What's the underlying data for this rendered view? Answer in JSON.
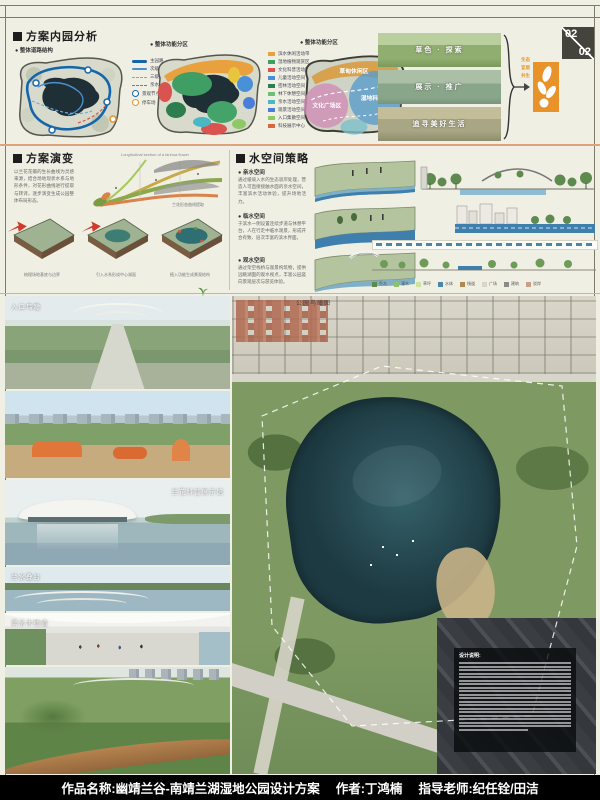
{
  "colors": {
    "paper": "#f0efe4",
    "accent_orange": "#e8922a",
    "footer_bg": "#000000",
    "divider_salmon": "#dfa27c",
    "lake_teal": "#24454d"
  },
  "page_indicator": {
    "current": "02",
    "total": "02"
  },
  "analysis": {
    "title": "方案内园分析",
    "road_diagram": {
      "caption": "● 整体道路结构",
      "legend": [
        {
          "label": "主园路"
        },
        {
          "label": "次级园路"
        },
        {
          "label": "三级园路"
        },
        {
          "label": "亲水栈道"
        },
        {
          "label": "景观节点"
        },
        {
          "label": "停车场"
        }
      ]
    },
    "function_diagram": {
      "caption": "● 整体功能分区",
      "legend": [
        {
          "label": "滨水休闲活动带",
          "color": "#e8a13c"
        },
        {
          "label": "湿地植物观赏区",
          "color": "#3f9e63"
        },
        {
          "label": "文化科普活动区",
          "color": "#d9534f"
        },
        {
          "label": "儿童活动空间",
          "color": "#4a90d9"
        },
        {
          "label": "密林活动空间",
          "color": "#2e7d4f"
        },
        {
          "label": "林下休憩空间",
          "color": "#6fbf73"
        },
        {
          "label": "亲水活动空间",
          "color": "#49b8c4"
        },
        {
          "label": "观景活动空间",
          "color": "#4a7fd9"
        },
        {
          "label": "入口集散空间",
          "color": "#8fc866"
        },
        {
          "label": "科技展示中心",
          "color": "#d9663c"
        }
      ]
    },
    "zone_diagram": {
      "caption": "● 整体功能分区",
      "zones": [
        {
          "label": "草甸休闲区"
        },
        {
          "label": "湿地科普区"
        },
        {
          "label": "文化广场区"
        }
      ]
    },
    "concept_photos": [
      {
        "caption": "草色 · 探索"
      },
      {
        "caption": "展示 · 推广"
      },
      {
        "caption": "追寻美好生活"
      }
    ],
    "logo_tagline": [
      "生态",
      "宜居",
      "共生"
    ]
  },
  "evolution": {
    "title": "方案演变",
    "intro": "以兰花花瓣的生长曲线为灵感来源，结合场地现状水系与地形条件，对花形曲线进行提取与转译，逐步演变生成公园整体布局形态。",
    "orchid_caption": "Longitudinal section of a lanhua flower",
    "sketch_caption": "兰花形态曲线提取",
    "steps": [
      {
        "caption": "梳理场地基底与边界"
      },
      {
        "caption": "引入水系形成中心湖面"
      },
      {
        "caption": "植入功能生成景观结构"
      }
    ]
  },
  "water": {
    "title": "水空间策略",
    "items": [
      {
        "label": "● 亲水空间",
        "text": "通过缓坡入水的生态驳岸处理，营造人可直接接触水面的亲水空间，丰富滨水活动体验，提升场地活力。"
      },
      {
        "label": "● 临水空间",
        "text": "于滨水一侧设置连续步道与休憩平台，人在行走中临水观景，形成开合有致、层次丰富的滨水界面。"
      },
      {
        "label": "● 观水空间",
        "text": "通过架空栈桥与观景构筑物，提供远眺湖面的观水视点，丰富公园竖向景观层次与游览体验。"
      }
    ],
    "legend_chips": [
      {
        "label": "乔木"
      },
      {
        "label": "灌木"
      },
      {
        "label": "草坪"
      },
      {
        "label": "水体"
      },
      {
        "label": "栈道"
      },
      {
        "label": "广场"
      },
      {
        "label": "建筑"
      },
      {
        "label": "驳岸"
      }
    ]
  },
  "gallery": {
    "photos": [
      {
        "caption": "入口鸟瞰"
      },
      {
        "caption": ""
      },
      {
        "caption": "兰花科普展示馆"
      },
      {
        "caption": "兰水叠台"
      },
      {
        "caption": "滨水木栈道"
      },
      {
        "caption": ""
      }
    ]
  },
  "aerial": {
    "caption": "公园鸟瞰图",
    "note_title": "设计说明:"
  },
  "footer": {
    "project_label": "作品名称:",
    "project_name": "幽靖兰谷-南靖兰湖湿地公园设计方案",
    "author_label": "作者:",
    "author_name": "丁鸿楠",
    "advisor_label": "指导老师:",
    "advisor_name": "纪任铨/田洁"
  }
}
